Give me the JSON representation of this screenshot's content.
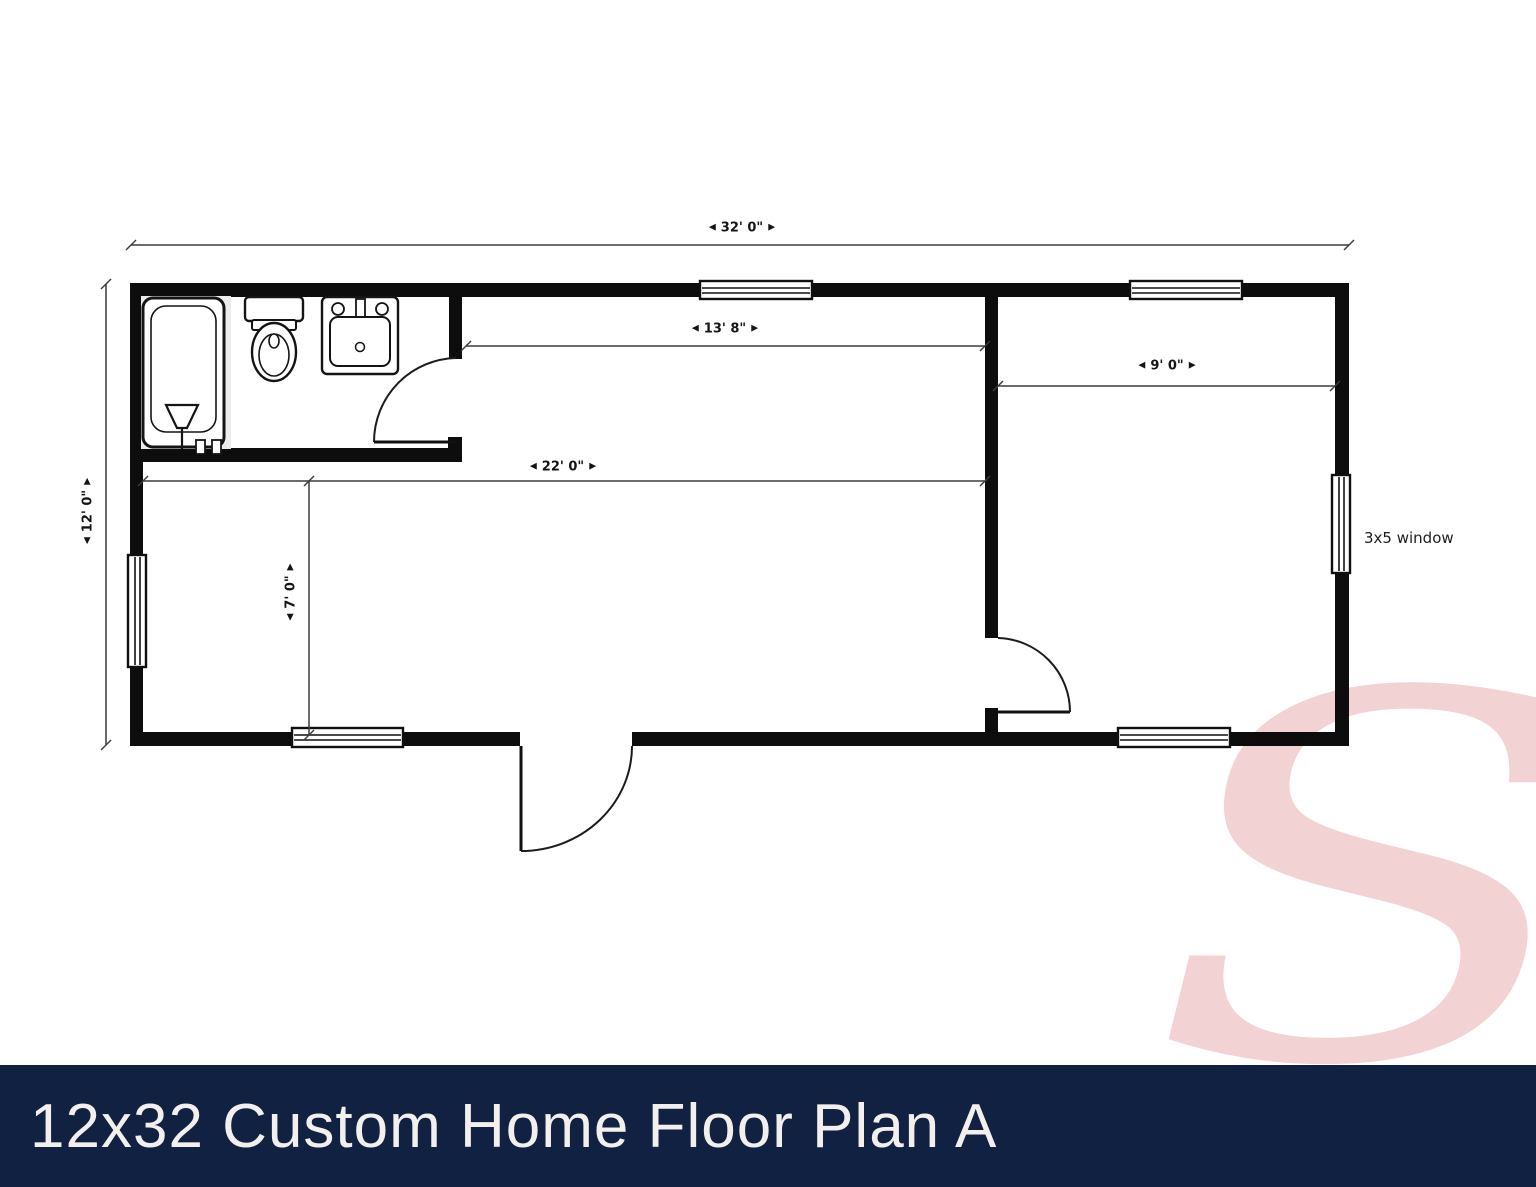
{
  "banner": {
    "title": "12x32 Custom Home Floor Plan A"
  },
  "watermark": {
    "letter": "S"
  },
  "floor_plan": {
    "arrows": {
      "left": "◀",
      "right": "▶"
    },
    "dims": {
      "overall_width": "32' 0\"",
      "overall_depth": "12' 0\"",
      "living_room_top_width": "13' 8\"",
      "living_room_width": "22' 0\"",
      "bedroom_width": "9' 0\"",
      "left_room_depth": "7' 0\""
    },
    "notes": {
      "window_note": "3x5 window"
    },
    "colors": {
      "wall": "#0d0d0d",
      "dimension_line": "#3c3c3c",
      "banner_bg": "#112142",
      "banner_text": "#f2efec",
      "watermark_pink": "#f3d2d4"
    }
  }
}
